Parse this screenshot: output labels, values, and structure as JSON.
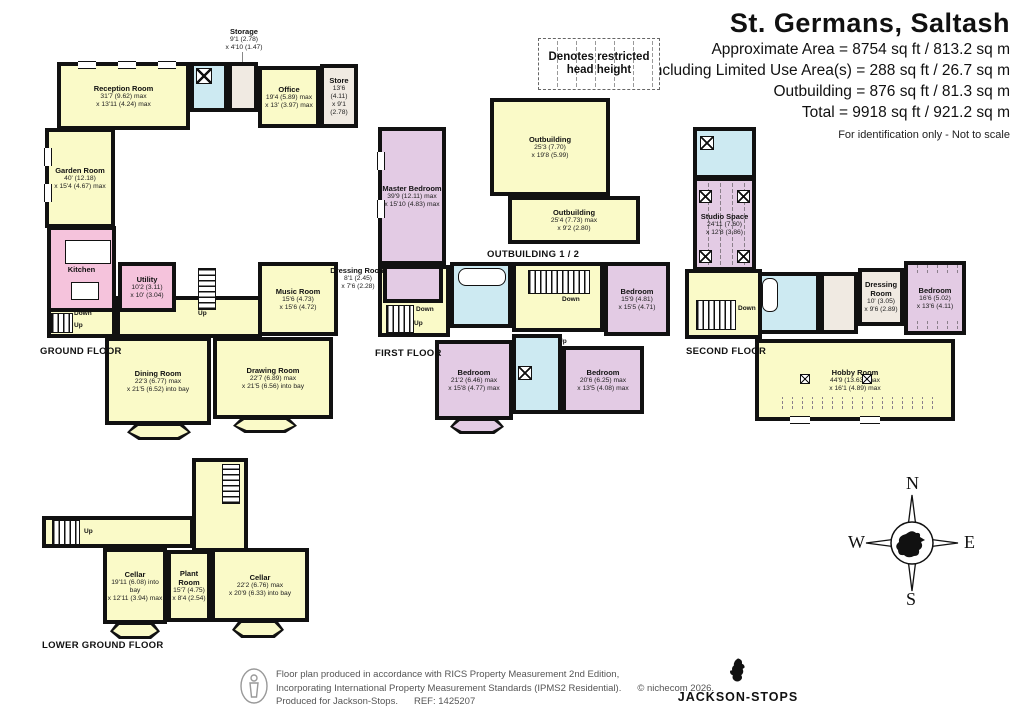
{
  "header": {
    "title": "St. Germans, Saltash",
    "lines": [
      "Approximate Area = 8754 sq ft / 813.2 sq m",
      "Including Limited Use Area(s) = 288 sq ft / 26.7 sq m",
      "Outbuilding = 876 sq ft / 81.3 sq m",
      "Total = 9918 sq ft / 921.2 sq m"
    ],
    "note": "For identification only - Not to scale"
  },
  "legend": {
    "restricted_label": "Denotes restricted head height"
  },
  "floor_labels": {
    "ground": "GROUND FLOOR",
    "first": "FIRST FLOOR",
    "second": "SECOND FLOOR",
    "lower": "LOWER GROUND FLOOR",
    "outbuilding": "OUTBUILDING 1 / 2"
  },
  "stairs": {
    "up": "Up",
    "down": "Down"
  },
  "rooms": {
    "storage": {
      "name": "Storage",
      "d1": "9'1 (2.78)",
      "d2": "x 4'10 (1.47)"
    },
    "reception": {
      "name": "Reception Room",
      "d1": "31'7 (9.62) max",
      "d2": "x 13'11 (4.24) max"
    },
    "office": {
      "name": "Office",
      "d1": "19'4 (5.89) max",
      "d2": "x 13' (3.97) max"
    },
    "store": {
      "name": "Store",
      "d1": "13'6 (4.11)",
      "d2": "x 9'1 (2.78)"
    },
    "garden": {
      "name": "Garden Room",
      "d1": "40' (12.18)",
      "d2": "x 15'4 (4.67) max"
    },
    "kitchen": {
      "name": "Kitchen"
    },
    "utility": {
      "name": "Utility",
      "d1": "10'2 (3.11)",
      "d2": "x 10' (3.04)"
    },
    "music": {
      "name": "Music Room",
      "d1": "15'6 (4.73)",
      "d2": "x 15'6 (4.72)"
    },
    "dining": {
      "name": "Dining Room",
      "d1": "22'3 (6.77) max",
      "d2": "x 21'5 (6.52) into bay"
    },
    "drawing": {
      "name": "Drawing Room",
      "d1": "22'7 (6.89) max",
      "d2": "x 21'5 (6.56) into bay"
    },
    "master": {
      "name": "Master Bedroom",
      "d1": "39'9 (12.11) max",
      "d2": "x 15'10 (4.83) max"
    },
    "dressing1": {
      "name": "Dressing Room",
      "d1": "8'1 (2.45)",
      "d2": "x 7'6 (2.28)"
    },
    "bedroom1": {
      "name": "Bedroom",
      "d1": "15'9 (4.81)",
      "d2": "x 15'5 (4.71)"
    },
    "bedroom2": {
      "name": "Bedroom",
      "d1": "21'2 (6.46) max",
      "d2": "x 15'8 (4.77) max"
    },
    "bedroom3": {
      "name": "Bedroom",
      "d1": "20'6 (6.25) max",
      "d2": "x 13'5 (4.08) max"
    },
    "outbuilding1": {
      "name": "Outbuilding",
      "d1": "25'3 (7.70)",
      "d2": "x 19'8 (5.99)"
    },
    "outbuilding2": {
      "name": "Outbuilding",
      "d1": "25'4 (7.73) max",
      "d2": "x 9'2 (2.80)"
    },
    "studio": {
      "name": "Studio Space",
      "d1": "24'11 (7.60)",
      "d2": "x 12'8 (3.86)"
    },
    "dressing2": {
      "name": "Dressing Room",
      "d1": "10' (3.05)",
      "d2": "x 9'6 (2.89)"
    },
    "bedroom4": {
      "name": "Bedroom",
      "d1": "16'6 (5.02)",
      "d2": "x 13'6 (4.11)"
    },
    "hobby": {
      "name": "Hobby Room",
      "d1": "44'9 (13.63) max",
      "d2": "x 16'1 (4.89) max"
    },
    "cellar1": {
      "name": "Cellar",
      "d1": "19'11 (6.08) into bay",
      "d2": "x 12'11 (3.94) max"
    },
    "plant": {
      "name": "Plant Room",
      "d1": "15'7 (4.75)",
      "d2": "x 8'4 (2.54)"
    },
    "cellar2": {
      "name": "Cellar",
      "d1": "22'2 (6.76) max",
      "d2": "x 20'9 (6.33) into bay"
    }
  },
  "compass": {
    "n": "N",
    "e": "E",
    "s": "S",
    "w": "W"
  },
  "footer": {
    "line1": "Floor plan produced in accordance with RICS Property Measurement 2nd Edition,",
    "line2": "Incorporating International Property Measurement Standards (IPMS2 Residential).",
    "copyright": "© nichecom 2026.",
    "line3": "Produced for Jackson-Stops.",
    "ref": "REF: 1425207",
    "brand": "JACKSON-STOPS"
  },
  "colors": {
    "room_yellow": "#FAFAC8",
    "room_pink": "#F5C3DC",
    "room_mauve": "#E3CBE4",
    "room_blue": "#CDEAF2",
    "room_beige": "#F0EAE2",
    "wall": "#111111"
  }
}
